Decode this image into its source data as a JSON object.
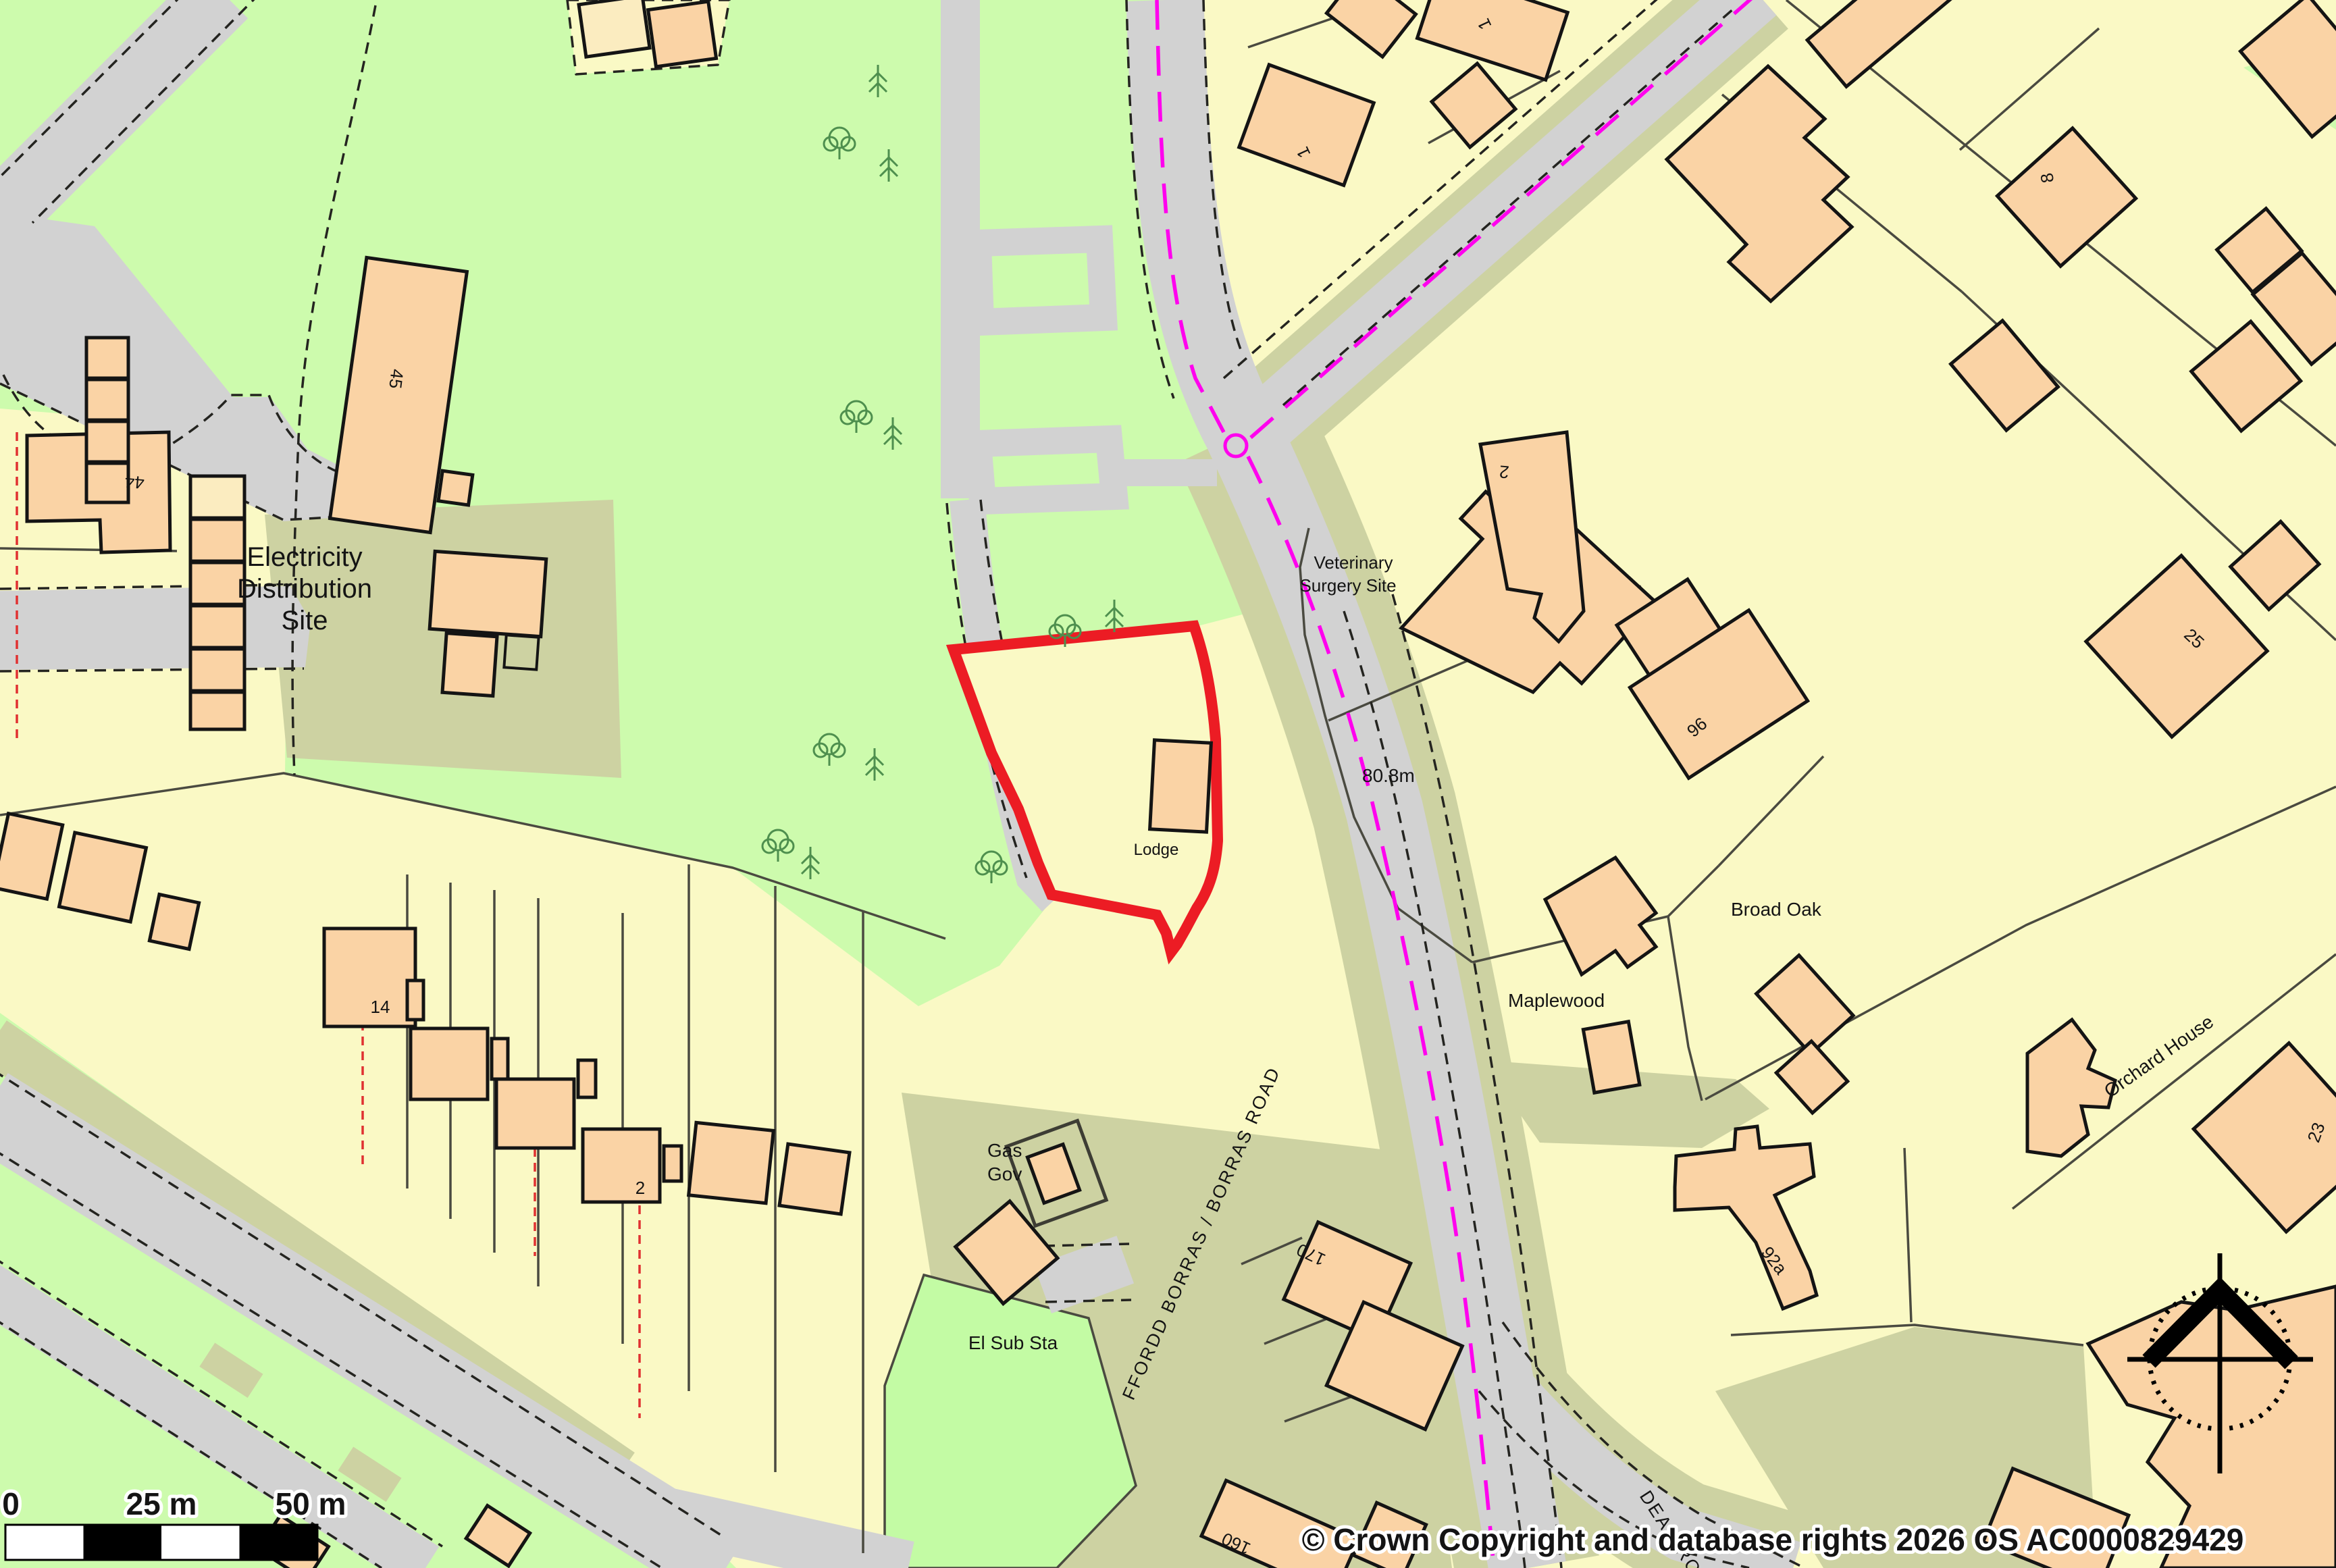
{
  "map": {
    "copyright": "© Crown Copyright and database rights 2026 OS AC0000829429",
    "scale": {
      "s0": "0",
      "s25": "25 m",
      "s50": "50 m"
    },
    "labels": {
      "electricity1": "Electricity",
      "electricity2": "Distribution",
      "electricity3": "Site",
      "vet1": "Veterinary",
      "vet2": "Surgery Site",
      "lodge": "Lodge",
      "gas1": "Gas",
      "gas2": "Gov",
      "elsub": "El Sub Sta",
      "spot_height": "80.8m",
      "broadoak": "Broad Oak",
      "maplewood": "Maplewood",
      "orchard": "Orchard House"
    },
    "roads": {
      "main": "FFORDD BORRAS / BORRAS ROAD",
      "dean": "DEAN ROAD"
    },
    "numbers": {
      "n45": "45",
      "n44": "44",
      "n14": "14",
      "n2_left": "2",
      "n1_a": "1",
      "n1_b": "1",
      "n8": "8",
      "n2_vet": "2",
      "n25": "25",
      "n96": "96",
      "n23": "23",
      "n92a": "92a",
      "n170": "170",
      "n160": "160"
    },
    "colors": {
      "plot_yellow": "#FAF9C5",
      "park_green": "#CDFBAD",
      "substation_green": "#C3FBA4",
      "verge_olive": "#CDD2A2",
      "road_gray": "#D2D2D2",
      "building_peach": "#FAD3A5",
      "building_cream": "#FBECC0",
      "site_boundary_red": "#EC1C24",
      "admin_boundary_magenta": "#FF00EE",
      "plot_dashed_red": "#E03131",
      "outline_black": "#141414"
    }
  }
}
